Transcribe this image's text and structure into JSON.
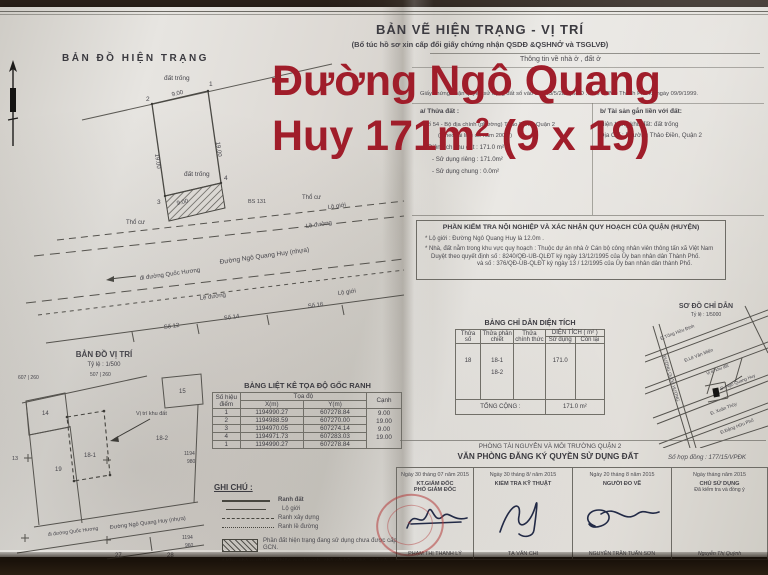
{
  "overlay": {
    "line1": "Đường Ngô Quang",
    "line2_pre": "Huy 171m",
    "line2_sup": "2",
    "line2_post": " (9 x 19)",
    "color": "#a01d2a"
  },
  "header": {
    "title": "BẢN VẼ HIỆN TRẠNG - VỊ TRÍ",
    "subtitle": "(Bổ túc hồ sơ xin cấp đổi giấy chứng nhận QSDĐ &QSHNỞ và TSGLVĐ)"
  },
  "info": {
    "section_label": "Thông tin về nhà ở , đất ở",
    "gcn_line": "Giấy chứng nhận quyền sử dụng đất số vào sổ 003/5/2B QSDĐ … do UBND Thành Phố ký ngày 09/9/1999.",
    "a": {
      "heading": "a/ Thửa đất :",
      "line1": "Số 54 - Bộ địa chính (phường) Thảo Điền - Quận 2",
      "line2": "( Theo tài liệu đo năm 2003 )",
      "area": "Diện tích khu đất :  171.0 m²",
      "private": "- Sử dụng riêng :  171.0m²",
      "common": "- Sử dụng chung :   0.0m²"
    },
    "b": {
      "heading": "b/ Tài sản gắn liền với đất:",
      "line1": "Hiện trạng khu đất: đất trống",
      "line2": "Địa Chỉ :    Phường Thảo Điền, Quận 2"
    }
  },
  "inspection": {
    "title": "PHẦN KIỂM TRA NỘI NGHIỆP VÀ XÁC NHẬN QUY HOẠCH CỦA QUẬN (HUYỆN)",
    "line1": "* Lộ giới :  Đường Ngô Quang Huy là 12.0m .",
    "line2": "* Nhà, đất nằm trong khu vực quy hoạch : Thuộc dự án nhà ở Cán bộ công nhân viên thông tấn xã Việt Nam",
    "line3": "Duyệt theo quyết định số : 8240/QĐ-UB-QLĐT ký ngày 13/12/1995 của Ủy ban nhân dân Thành Phố.",
    "line4": "và số : 376/QĐ-UB-QLĐT ký ngày 13 / 12/1995 của Ủy ban nhân dân thành Phố."
  },
  "plan": {
    "title": "BẢN ĐỒ HIỆN TRẠNG",
    "labels": {
      "dat_trong_top": "đất trống",
      "dat_trong_in": "đất trống",
      "dim_top": "9.00",
      "dim_bottom": "9.00",
      "dim_left": "19.00",
      "dim_right": "19.00",
      "p1": "1",
      "p2": "2",
      "p3": "3",
      "p4": "4",
      "tho_cu_left": "Thổ cư",
      "tho_cu_right": "Thổ cư",
      "bs": "BS 131",
      "lo_gioi_top": "Lộ giới",
      "le_duong_top": "Lề đường",
      "le_duong_bottom": "Lề đường",
      "lo_gioi_bottom": "Lộ giới",
      "road": "Đường Ngô Quang Huy (nhựa)",
      "to_road": "đi đường Quốc Hương",
      "so12": "Số 12",
      "so14": "Số 14",
      "so16": "Số 16"
    }
  },
  "vitri": {
    "title": "BẢN ĐỒ VỊ TRÍ",
    "scale": "Tỷ lệ : 1/500",
    "labels": {
      "p14": "14",
      "p15": "15",
      "p19": "19",
      "p181": "18-1",
      "p182": "18-2",
      "p13": "13",
      "p27": "27",
      "p28": "28",
      "grid1": "607 | 260",
      "grid2": "507 | 260",
      "r1a": "1194",
      "r1b": "980",
      "r2a": "1194",
      "r2b": "960",
      "marker": "Vị trí khu đất",
      "road": "Đường Ngô Quang Huy (nhựa)",
      "to_road": "đi đường Quốc Hương"
    }
  },
  "coord_table": {
    "title": "BẢNG LIỆT KÊ TỌA ĐỘ GỐC RANH",
    "col_point": "Số hiệu điểm",
    "col_coord": "Tọa độ",
    "col_x": "X(m)",
    "col_y": "Y(m)",
    "col_edge": "Cạnh",
    "rows": [
      [
        "1",
        "1194990.27",
        "607278.84"
      ],
      [
        "2",
        "1194988.59",
        "607270.00"
      ],
      [
        "3",
        "1194970.05",
        "607274.14"
      ],
      [
        "4",
        "1194971.73",
        "607283.03"
      ],
      [
        "1",
        "1194990.27",
        "607278.84"
      ]
    ],
    "edges": [
      "9.00",
      "19.00",
      "9.00",
      "19.00"
    ]
  },
  "legend": {
    "title": "GHI CHÚ :",
    "item1": "Ranh đất",
    "item2": "Lộ giới",
    "item3": "Ranh xây dựng",
    "item4": "Ranh lề đường",
    "hatch_note": "Phần đất hiện trạng đang sử dụng chưa được cấp GCN.",
    "note1": "* Khu nhà nước thực hiện quy hoạch, chủ sở hữu nhà, chủ sử dụng đất phải chấp hành theo quy định",
    "note2": "⊕ Ranh giới thửa đất do chủ sử dụng hướng dẫn và chịu trách nhiệm."
  },
  "area_table": {
    "title": "BẢNG CHỈ DẪN DIỆN TÍCH",
    "col1": "Thửa số",
    "col2": "Thửa phân chiết",
    "col3": "Thửa chính thức",
    "col4": "DIỆN TÍCH ( m² )",
    "col4a": "Sử dụng",
    "col4b": "Còn lại",
    "row": {
      "thua": "18",
      "sub1": "18-1",
      "sub2": "18-2",
      "sudung": "171.0"
    },
    "total_label": "TỔNG CỘNG :",
    "total_value": "171.0",
    "total_unit": "m²"
  },
  "sodo": {
    "title": "SƠ ĐỒ CHỈ DẪN",
    "scale": "Tỷ lệ :  1/5000",
    "labels": {
      "s1": "Đ.Tống Hữu Định",
      "s2": "Đ.Lê Văn Miến",
      "s3": "Đ. Ngô Quang Huy",
      "s4": "Đ. Xuân Thủy",
      "s5": "Đ.Đặng Hữu Phổ",
      "s6": "ĐƯỜNG QUỐC HƯƠNG",
      "marker": "Vị trí khu đất"
    }
  },
  "office": {
    "line1": "PHÒNG TÀI NGUYÊN VÀ MÔI TRƯỜNG QUẬN 2",
    "line2": "VĂN PHÒNG ĐĂNG KÝ QUYỀN SỬ DỤNG ĐẤT",
    "contract": "Số hợp đồng : 177/15/VPĐK",
    "signers": [
      {
        "date": "Ngày 30 tháng 07 năm 2015",
        "role1": "KT.GIÁM ĐỐC",
        "role2": "PHÓ GIÁM ĐỐC",
        "name": "PHẠM THỊ THANH LÝ"
      },
      {
        "date": "Ngày 30 tháng 8/ năm 2015",
        "role1": "KIỂM TRA KỸ THUẬT",
        "role2": "",
        "name": "TẠ VĂN CHI"
      },
      {
        "date": "Ngày 20 tháng 8 năm 2015",
        "role1": "NGƯỜI ĐO VẼ",
        "role2": "",
        "name": "NGUYỄN TRẦN TUẤN SƠN"
      },
      {
        "date": "Ngày     tháng     năm 2015",
        "role1": "CHỦ SỬ DỤNG",
        "role2": "Đã kiểm tra và đồng ý",
        "name": "Nguyễn Thị Quỳnh"
      }
    ]
  }
}
